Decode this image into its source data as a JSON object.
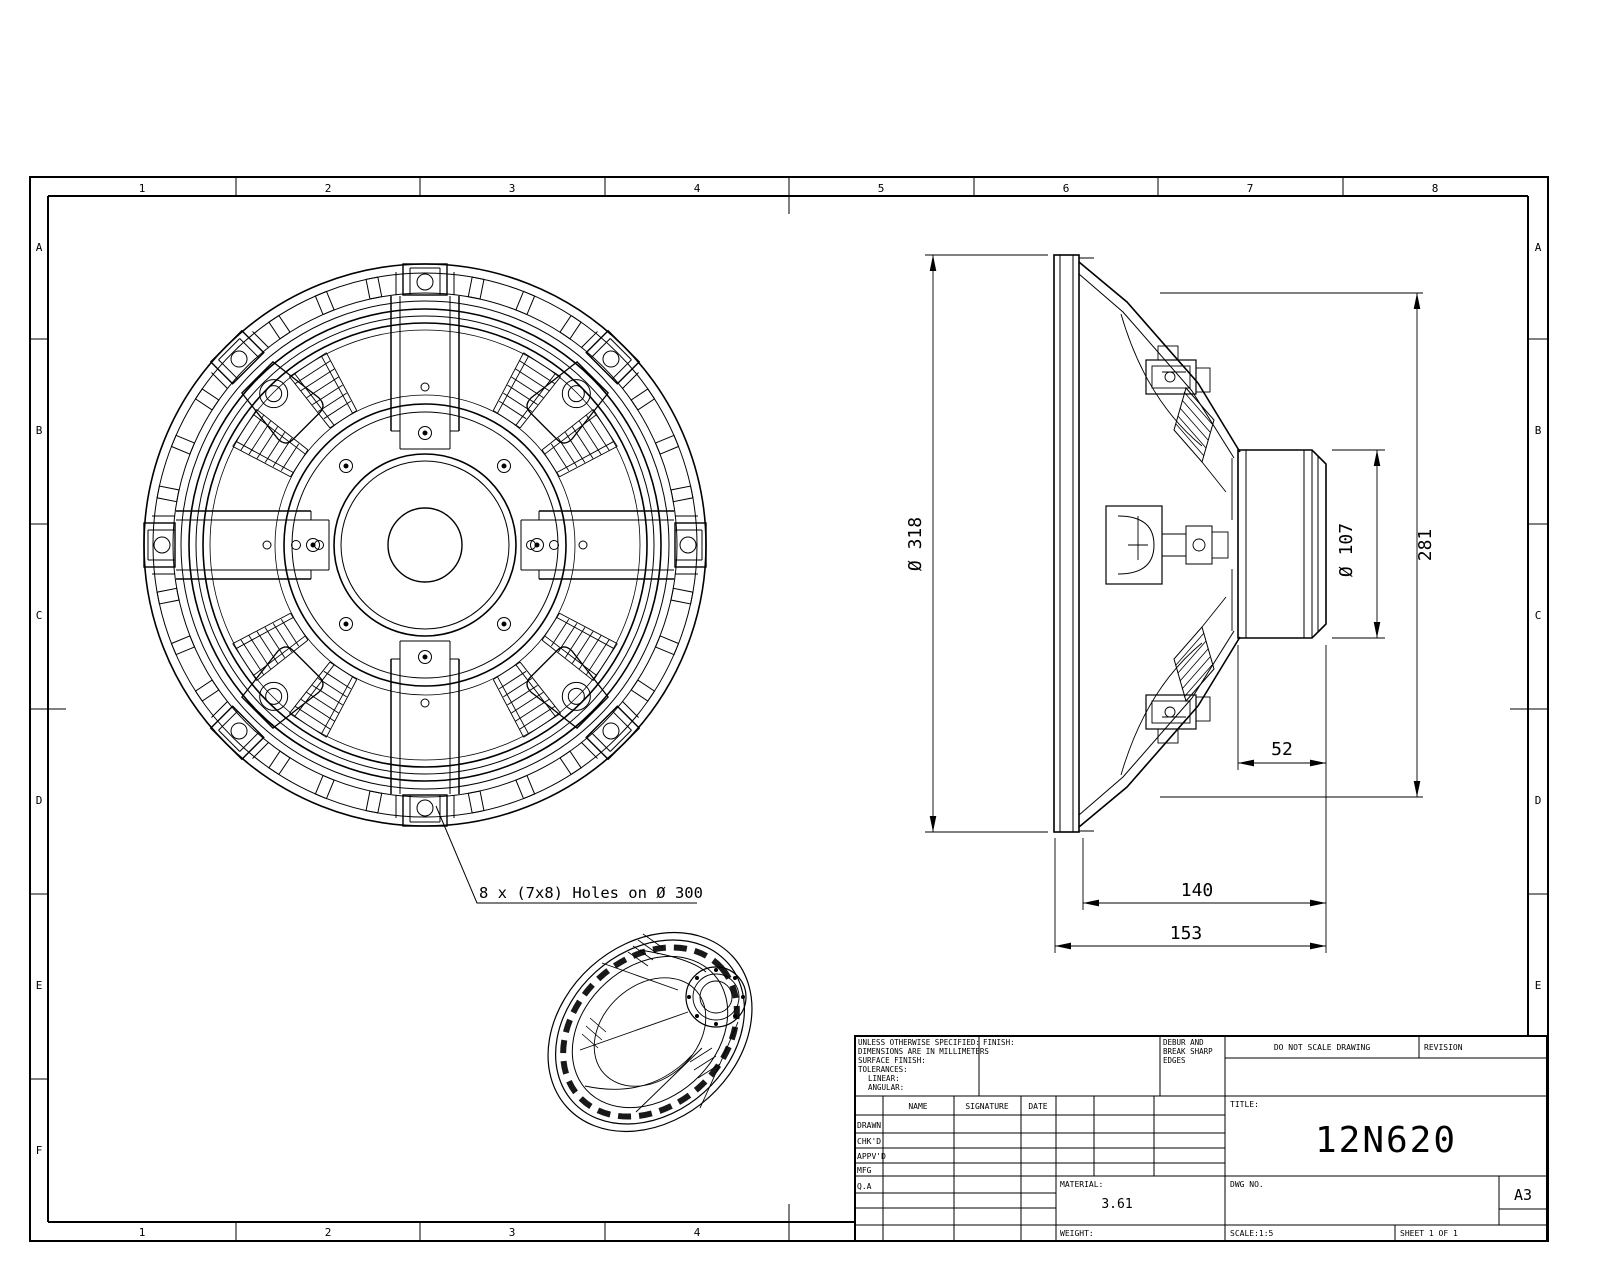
{
  "sheet": {
    "cols": [
      "1",
      "2",
      "3",
      "4",
      "5",
      "6",
      "7",
      "8"
    ],
    "rows": [
      "A",
      "B",
      "C",
      "D",
      "E",
      "F"
    ],
    "paper_size": "A3"
  },
  "drawing": {
    "title": "12N620",
    "annotation_holes": "8 x (7x8) Holes on Ø 300",
    "dimensions": {
      "front_diameter": "Ø 318",
      "magnet_diameter": "Ø 107",
      "bolt_depth": "281",
      "magnet_depth": "52",
      "frame_depth": "140",
      "overall_depth": "153"
    }
  },
  "title_block": {
    "tolerance_note": [
      "UNLESS OTHERWISE SPECIFIED:",
      "DIMENSIONS ARE IN MILLIMETERS",
      "SURFACE FINISH:",
      "TOLERANCES:",
      "LINEAR:",
      "ANGULAR:"
    ],
    "finish_label": "FINISH:",
    "debur_note": [
      "DEBUR AND",
      "BREAK SHARP",
      "EDGES"
    ],
    "do_not_scale": "DO NOT SCALE DRAWING",
    "revision_label": "REVISION",
    "name_label": "NAME",
    "signature_label": "SIGNATURE",
    "date_label": "DATE",
    "row_labels": [
      "DRAWN",
      "CHK'D",
      "APPV'D",
      "MFG",
      "Q.A"
    ],
    "title_label": "TITLE:",
    "dwg_no_label": "DWG NO.",
    "material_label": "MATERIAL:",
    "material_value": "3.61",
    "weight_label": "WEIGHT:",
    "scale_label": "SCALE:1:5",
    "sheet_label": "SHEET 1 OF 1",
    "paper_size": "A3"
  }
}
